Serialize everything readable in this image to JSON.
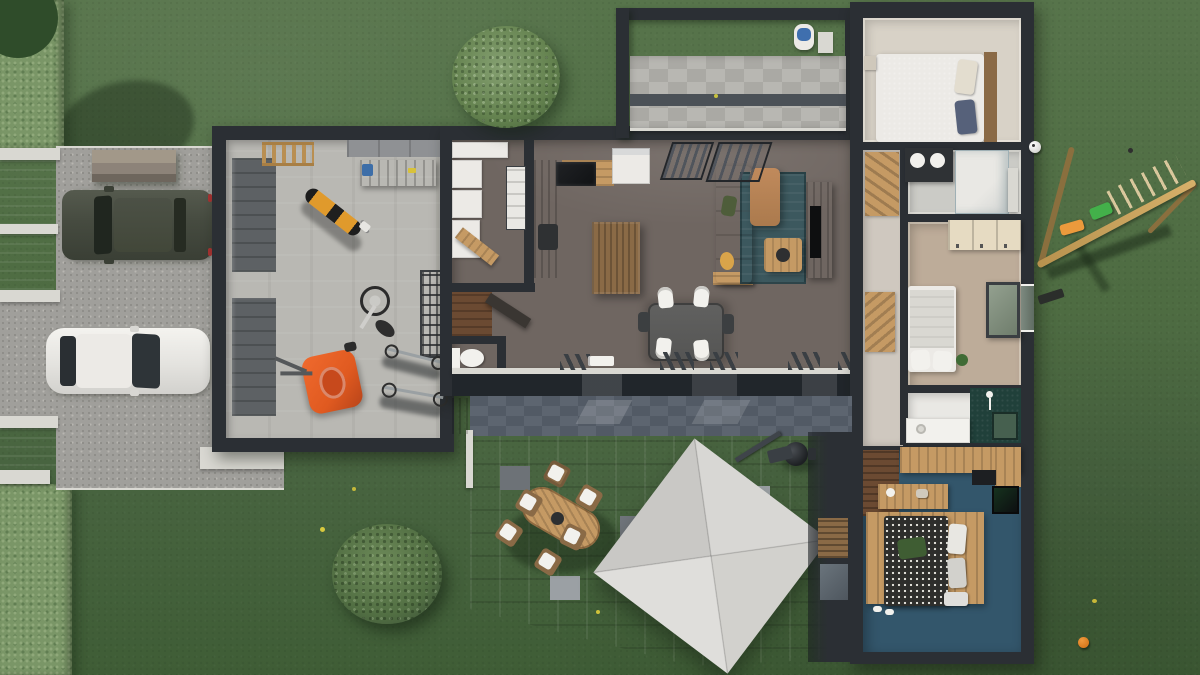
{
  "meta": {
    "title": "3D top-down architectural rendering of a single-storey house with garden",
    "view": "aerial orthographic 3D floor plan",
    "visible_text": ""
  },
  "palette": {
    "grass": "#4e6c42",
    "grassLight": "#57744b",
    "grassDark": "#3f5d36",
    "hedge": "#7a9667",
    "hedgeDot1": "#8fa87a",
    "hedgeDot2": "#617e52",
    "foliageDark": "#2f4c2a",
    "gravel": "#a09f9b",
    "gravelDot1": "#8e8d88",
    "gravelDot2": "#b7b6b0",
    "curb": "#d9d8d2",
    "wallDark": "#2b2f34",
    "glassDark": "#21262b",
    "garageFloor": "#b9b8b3",
    "doorPanel": "#5d6164",
    "interiorFloor": "#6f6661",
    "hallFloor": "#cfc8bf",
    "bedroom1Floor": "#d8d2c7",
    "bathFloor": "#cbcbc6",
    "bed2Floor": "#bdac99",
    "woodLight": "#c59a64",
    "woodMid": "#8a6a46",
    "woodDark": "#6b4a32",
    "applianceWhite": "#eceae6",
    "white": "#f2f1ed",
    "rugTeal": "#3c585e",
    "sofaTan": "#c08a5c",
    "cushionGreen": "#4e5d3a",
    "cushionOrange": "#d9a44a",
    "mowerOrange": "#e05a20",
    "motoYellow": "#e09a2c",
    "bedNavy": "#3f4d66",
    "bedGrayBlue": "#8b94a2",
    "creamDoors": "#e6dbc2",
    "tealWall": "#20403a",
    "tealFloor": "#33566b",
    "slateDark": "#59616c",
    "paverA": "#8a8f94",
    "paverB": "#7d8287",
    "walkA": "#b8b7b2",
    "walkB": "#aaa9a4",
    "parasol": "#d5d4d0",
    "swingWood": "#c9a158",
    "swingWoodDark": "#8a6f3e",
    "seatGreen": "#43b04a",
    "seatOrange": "#eb9a3c",
    "ballOrange": "#d97a1e"
  },
  "scene": {
    "outdoor_items": [
      "hedge",
      "entrance-gate",
      "gravel-driveway",
      "suv-dark",
      "car-white",
      "storage-box",
      "round-bush-top",
      "round-bush-bottom",
      "pergola",
      "front-walkway",
      "robot-mower-dock",
      "paved-terrace",
      "outdoor-dining-table",
      "outdoor-chairs",
      "cantilever-parasol",
      "barbecue-grill",
      "privacy-screen-wall",
      "wooden-swing-set",
      "soccer-ball",
      "orange-ball",
      "yellow-flowers"
    ],
    "rooms": [
      {
        "id": "garage",
        "items": [
          "garage-door-1",
          "garage-door-2",
          "wall-ladder",
          "workbench",
          "storage-panels",
          "motorcycle",
          "fallen-bicycle",
          "shelving-rack",
          "lawn-mower",
          "bicycles"
        ]
      },
      {
        "id": "utility-room",
        "items": [
          "washer-dryer-stack",
          "white-cabinets",
          "storage-bins",
          "ironing-board"
        ]
      },
      {
        "id": "wc",
        "items": [
          "toilet"
        ]
      },
      {
        "id": "kitchen",
        "items": [
          "counter",
          "sink",
          "cooktop",
          "fridge",
          "island"
        ]
      },
      {
        "id": "dining-area",
        "items": [
          "dining-table",
          "white-chairs",
          "dark-chairs",
          "sideboard"
        ]
      },
      {
        "id": "living-room",
        "items": [
          "l-sofa",
          "teal-rug",
          "coffee-table",
          "tv-console",
          "tv",
          "curtained-windows",
          "sliding-glass-doors"
        ]
      },
      {
        "id": "entry-hall",
        "items": [
          "front-door",
          "wardrobe",
          "closet"
        ]
      },
      {
        "id": "bedroom-1",
        "items": [
          "double-bed-navy",
          "headboard",
          "nightstand"
        ]
      },
      {
        "id": "bathroom-1",
        "items": [
          "dark-vanity",
          "round-basins",
          "walk-in-shower"
        ]
      },
      {
        "id": "bedroom-2",
        "items": [
          "single-bed",
          "cream-closet",
          "leaning-mirror",
          "plant",
          "window"
        ]
      },
      {
        "id": "bathroom-2",
        "items": [
          "white-vanity",
          "teal-accent-wall",
          "shower-fixture"
        ]
      },
      {
        "id": "master-bedroom",
        "items": [
          "double-bed-patterned",
          "wood-headboard-unit",
          "dresser",
          "wall-tv",
          "wood-area-rug",
          "slippers",
          "bench"
        ]
      }
    ]
  }
}
